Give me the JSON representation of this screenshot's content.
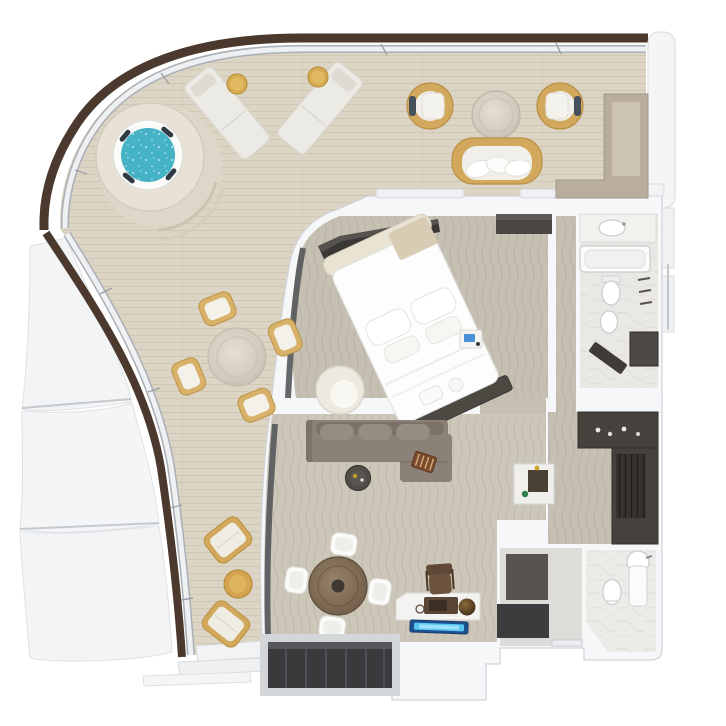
{
  "scene": {
    "label": "Top-down 3D floor plan rendering of a luxury ship suite with wrap-around private terrace",
    "background": "#ffffff"
  },
  "colors": {
    "railing_wood": "#4a392c",
    "glass_rail": "#eef0f2",
    "glass_rail_edge": "#aab0b6",
    "deck_wood": "#dcd4c4",
    "deck_grain": "#c2b89f",
    "hull_panel": "#f3f4f6",
    "wall": "#f6f7f9",
    "wall_edge": "#cfd3d8",
    "carpet_bedroom": "#c6c0b3",
    "carpet_living": "#cdc7ba",
    "carpet_wave": "#8d887c",
    "marble_floor": "#eae8e4",
    "hot_tub_water": "#45b2c6",
    "wicker_tan": "#d2a85c",
    "stone_table": "#d2ccc0",
    "sofa_taupe": "#8b8177",
    "dark_wood": "#45413d",
    "closet_dark": "#35322f",
    "window_glass_dark": "#3a3a3d",
    "indoor_table_wood": "#87755f",
    "plaque_blue": "#57c7f2",
    "device_blue": "#4a90d9"
  },
  "rooms": {
    "terrace": "Private wrap-around terrace with wood decking",
    "hot_tub_area": "Whirlpool hot tub on stepped platform",
    "outdoor_lounge": "Outdoor lounge with wicker armchairs, loveseat and stone coffee table",
    "outdoor_dining": "Outdoor dining table with four wicker chairs",
    "terrace_lounge_corner": "Two terrace lounge chairs with drum side table",
    "bedroom": "Bedroom with angled king bed, swivel chair and TV dresser",
    "living_room": "Living room with sectional sofa, coffee table and dining table",
    "master_bathroom": "Master bathroom with bathtub, toilet, bidet, vanity and shower",
    "dressing_room": "Walk-in dressing room with dark wood wardrobes",
    "guest_bathroom": "Guest bathroom with toilet and pedestal washbasin",
    "entry_hall": "Entry hall with dark floor mats",
    "hull": "Ship hull panels below the terrace"
  },
  "furniture": {
    "terrace": [
      "hot tub",
      "sun lounger left",
      "sun lounger right",
      "round side table left",
      "round side table right",
      "wicker armchair left",
      "wicker armchair right",
      "stone coffee table",
      "wicker loveseat with pillows",
      "storage counter",
      "stone dining table",
      "dining chair x4",
      "lounge chair upper",
      "lounge chair lower",
      "drum side table"
    ],
    "interior": [
      "king bed",
      "headboard",
      "bed pillows",
      "beige throw",
      "foot bench",
      "nightstand with tablet",
      "swivel chair",
      "tv dresser",
      "bedroom wardrobe",
      "sectional sofa",
      "backgammon tray",
      "round coffee table",
      "dining table",
      "dining chair x4",
      "writing desk",
      "desk chair",
      "radio console",
      "decorative sphere",
      "vanity desk niche",
      "bathtub",
      "vanity sink",
      "toilet",
      "bidet",
      "shower",
      "shower bench",
      "wardrobe cabinets",
      "guest toilet",
      "pedestal sink",
      "entry mats",
      "window wall",
      "illuminated plaque"
    ]
  }
}
